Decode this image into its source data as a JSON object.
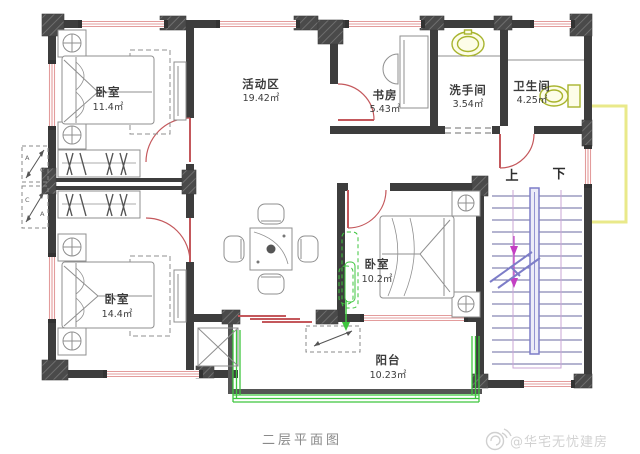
{
  "plan": {
    "caption": "二层平面图",
    "rooms": [
      {
        "id": "bedroom-top-left",
        "name": "卧室",
        "area": "11.4㎡"
      },
      {
        "id": "activity-area",
        "name": "活动区",
        "area": "19.42㎡"
      },
      {
        "id": "study",
        "name": "书房",
        "area": "5.43㎡"
      },
      {
        "id": "washroom",
        "name": "洗手间",
        "area": "3.54㎡"
      },
      {
        "id": "bathroom",
        "name": "卫生间",
        "area": "4.25㎡"
      },
      {
        "id": "bedroom-middle",
        "name": "卧室",
        "area": "10.2㎡"
      },
      {
        "id": "bedroom-bottom-left",
        "name": "卧室",
        "area": "14.4㎡"
      },
      {
        "id": "balcony",
        "name": "阳台",
        "area": "10.23㎡"
      }
    ],
    "stairs": {
      "up_label": "上",
      "down_label": "下"
    },
    "section_markers": {
      "letter_a": "A",
      "letter_c": "C"
    },
    "icons": [
      "bed",
      "nightstand",
      "wardrobe-hangers",
      "dining-table",
      "chair",
      "desk",
      "sink-icon",
      "toilet-icon",
      "stairs",
      "ac-unit-marker"
    ],
    "colors": {
      "wall": "#3d3d3d",
      "pier": "#565656",
      "window_pink": "#e39c9c",
      "door_red": "#c4585c",
      "furniture_gray": "#8f8f8f",
      "railing_green": "#3ec53e",
      "fixture_yellow_green": "#a8b42e",
      "stair_blue": "#7d7dc8",
      "stair_magenta": "#c33fc3",
      "awning_yellow": "#e9e98a",
      "label_text": "#3c3c3c",
      "watermark_gray": "#d2d2d2"
    }
  },
  "watermark": {
    "handle": "@华宅无忧建房",
    "icon": "weibo-icon"
  }
}
